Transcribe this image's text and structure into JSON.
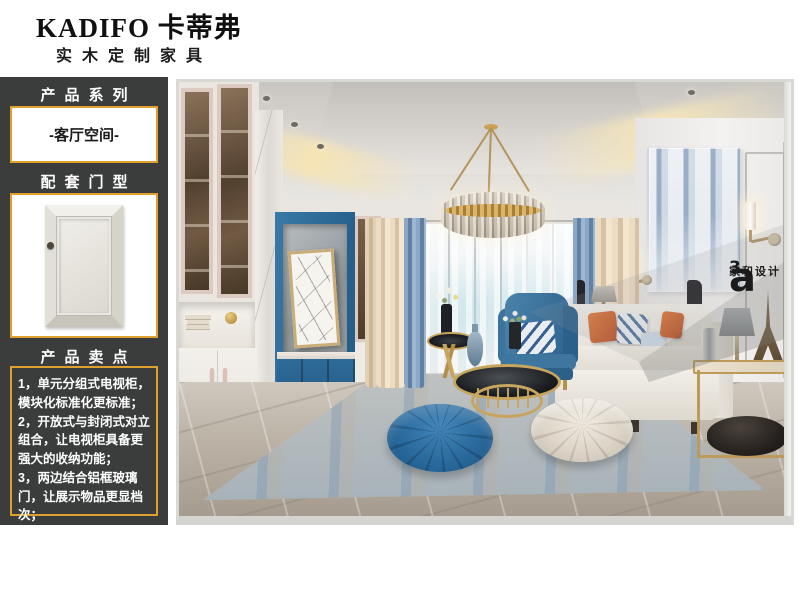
{
  "header": {
    "brand": "KADIFO 卡蒂弗",
    "subtitle": "实木定制家具"
  },
  "sidebar": {
    "series_label": "产品系列",
    "series_value": "-客厅空间-",
    "door_label": "配套门型",
    "selling_label": "产品卖点",
    "selling_points": [
      "1，单元分组式电视柜，模块化标准化更标准；",
      "2，开放式与封闭式对立组合，让电视柜具备更强大的收纳功能；",
      "3，两边结合铝框玻璃门，让展示物品更显档次；"
    ]
  },
  "photo": {
    "watermark": {
      "logo_letter": "a",
      "logo_sup": "3",
      "studio_name": "家和设计"
    }
  },
  "colors": {
    "accent_border": "#dfa02e",
    "sidebar_bg": "#3a3d3c",
    "theme_blue": "#2c6c9c",
    "photo_frame": "#d8d8d5"
  }
}
